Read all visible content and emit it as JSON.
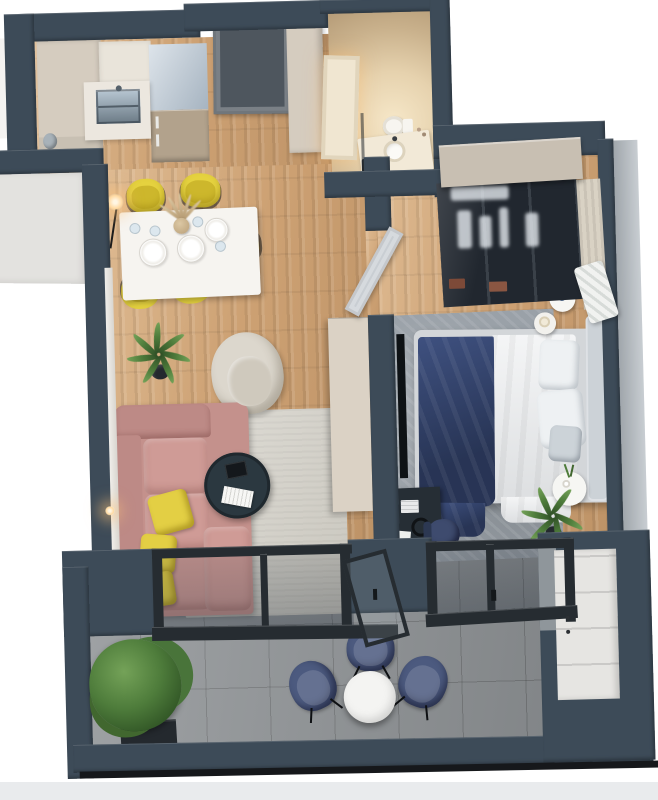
{
  "scene": {
    "description": "3D bird's-eye render of a one-bedroom apartment floor plan with balcony",
    "view": "top-down axonometric, slightly rotated",
    "background": "#ffffff"
  },
  "palette": {
    "wall": "#3d4b58",
    "wallOuter": "#b6bdc3",
    "extPanel": "#e3e2df",
    "extPanelLight": "#f4f3f1",
    "woodBase": "#cda173",
    "tile": "#8d9194",
    "bathFloor": "#d9c5a6",
    "cream": "#d5ccbf",
    "counter": "#ece7df",
    "counterBand": "#e9e4da",
    "sinkSteel": "#9fb0bd",
    "fridgeTop": "#b4c3d1",
    "fridgeFront": "#b2a28c",
    "binSteel": "#a8b2b9",
    "doorEntry": "#4e565e",
    "doorBath": "#f0e6d1",
    "doorBedroom": "#c9ced3",
    "tableWhite": "#f6f4f0",
    "chairYellow": "#e5d23f",
    "sofaPink": "#c4918c",
    "sofaPinkLight": "#cf9b96",
    "sofaPinkDark": "#bd8a86",
    "pillowYellow": "#e3cf44",
    "rugLiving": "#d6d3ca",
    "rugBedroom": "#9aa1a8",
    "coffeeTable": "#2b3840",
    "armchair": "#dcd7cd",
    "armchairSeat": "#cfc9bd",
    "sideboard": "#dbd2c5",
    "tv": "#0e1215",
    "bedBase": "#d3d6d9",
    "duvet": "#e9ebed",
    "navyBlanket": "#35466e",
    "headboard": "#ccd2d7",
    "pillowWhite": "#eef1f3",
    "pillowGray": "#ccd3d8",
    "wardrobeTop": "#c8bfb2",
    "wardrobeGlass": "#21272f",
    "curtain": "#d9d2c4",
    "desk": "#262e35",
    "deskChair": "#3e4b6e",
    "balconyChair": "#4c5a7f",
    "balconyTable": "#f4f4f2",
    "balconyCabinet": "#e6e5e2",
    "grayFace": "#8f969b",
    "plant": "#4e7c3b",
    "pot": "#24292e",
    "frame": "#262c31",
    "rail": "#16181b",
    "groundBand": "#e9ebed",
    "toiletWhite": "#f7f5f0",
    "basinWhite": "#fbfaf6",
    "bathCounter": "#f2e9d7",
    "paperWhite": "#eef0ee",
    "monitor": "#171c20"
  },
  "rooms": [
    {
      "id": "kitchen",
      "label": "Kitchen",
      "floor": "wood",
      "items": [
        {
          "name": "kitchen-cabinets",
          "color": "cream"
        },
        {
          "name": "kitchen-sink",
          "color": "sinkSteel"
        },
        {
          "name": "refrigerator",
          "color": "fridgeFront"
        },
        {
          "name": "entry-door",
          "color": "doorEntry"
        },
        {
          "name": "hall-cabinet",
          "color": "cream"
        },
        {
          "name": "steel-bin",
          "color": "binSteel"
        }
      ]
    },
    {
      "id": "dining",
      "label": "Dining area",
      "floor": "wood",
      "items": [
        {
          "name": "dining-table",
          "color": "tableWhite"
        },
        {
          "name": "dining-chair",
          "count": 5,
          "color": "chairYellow"
        },
        {
          "name": "place-setting",
          "count": 3
        },
        {
          "name": "drink-glass",
          "count": 4
        },
        {
          "name": "pampas-vase"
        },
        {
          "name": "floor-lamp"
        },
        {
          "name": "potted-palm",
          "color": "plant"
        }
      ]
    },
    {
      "id": "living",
      "label": "Living room",
      "floor": "wood",
      "items": [
        {
          "name": "corner-sofa",
          "color": "sofaPink"
        },
        {
          "name": "accent-pillow",
          "count": 3,
          "color": "pillowYellow"
        },
        {
          "name": "coffee-table",
          "color": "coffeeTable"
        },
        {
          "name": "magazine"
        },
        {
          "name": "laptop"
        },
        {
          "name": "area-rug",
          "color": "rugLiving"
        },
        {
          "name": "armchair",
          "color": "armchair"
        },
        {
          "name": "tv-sideboard",
          "color": "sideboard"
        },
        {
          "name": "wall-tv",
          "color": "tv"
        },
        {
          "name": "wall-sconce"
        }
      ]
    },
    {
      "id": "bathroom",
      "label": "Bathroom",
      "floor": "beige-stone",
      "items": [
        {
          "name": "bathroom-door",
          "color": "doorBath"
        },
        {
          "name": "toilet",
          "color": "toiletWhite"
        },
        {
          "name": "washbasin-counter",
          "color": "bathCounter"
        },
        {
          "name": "shower-screen"
        },
        {
          "name": "waste-bin",
          "color": "pot"
        }
      ]
    },
    {
      "id": "bedroom",
      "label": "Bedroom",
      "floor": "wood",
      "items": [
        {
          "name": "double-bed",
          "color": "duvet"
        },
        {
          "name": "bed-blanket",
          "color": "navyBlanket"
        },
        {
          "name": "bed-pillow",
          "count": 3
        },
        {
          "name": "glass-wardrobe",
          "color": "wardrobeGlass"
        },
        {
          "name": "nightstand",
          "count": 3
        },
        {
          "name": "table-lamp",
          "count": 1
        },
        {
          "name": "desk",
          "color": "desk"
        },
        {
          "name": "desk-chair",
          "color": "deskChair"
        },
        {
          "name": "area-rug",
          "color": "rugBedroom"
        },
        {
          "name": "bedroom-door",
          "color": "doorBedroom"
        },
        {
          "name": "potted-palm",
          "color": "plant"
        },
        {
          "name": "quilted-bench"
        }
      ]
    },
    {
      "id": "balcony",
      "label": "Balcony",
      "floor": "tile",
      "items": [
        {
          "name": "bistro-table",
          "color": "balconyTable"
        },
        {
          "name": "balcony-chair",
          "count": 3,
          "color": "balconyChair"
        },
        {
          "name": "planter-shrub",
          "color": "plant"
        },
        {
          "name": "storage-cabinet",
          "color": "balconyCabinet"
        },
        {
          "name": "glass-door-unit",
          "count": 2,
          "color": "frame"
        }
      ]
    }
  ]
}
